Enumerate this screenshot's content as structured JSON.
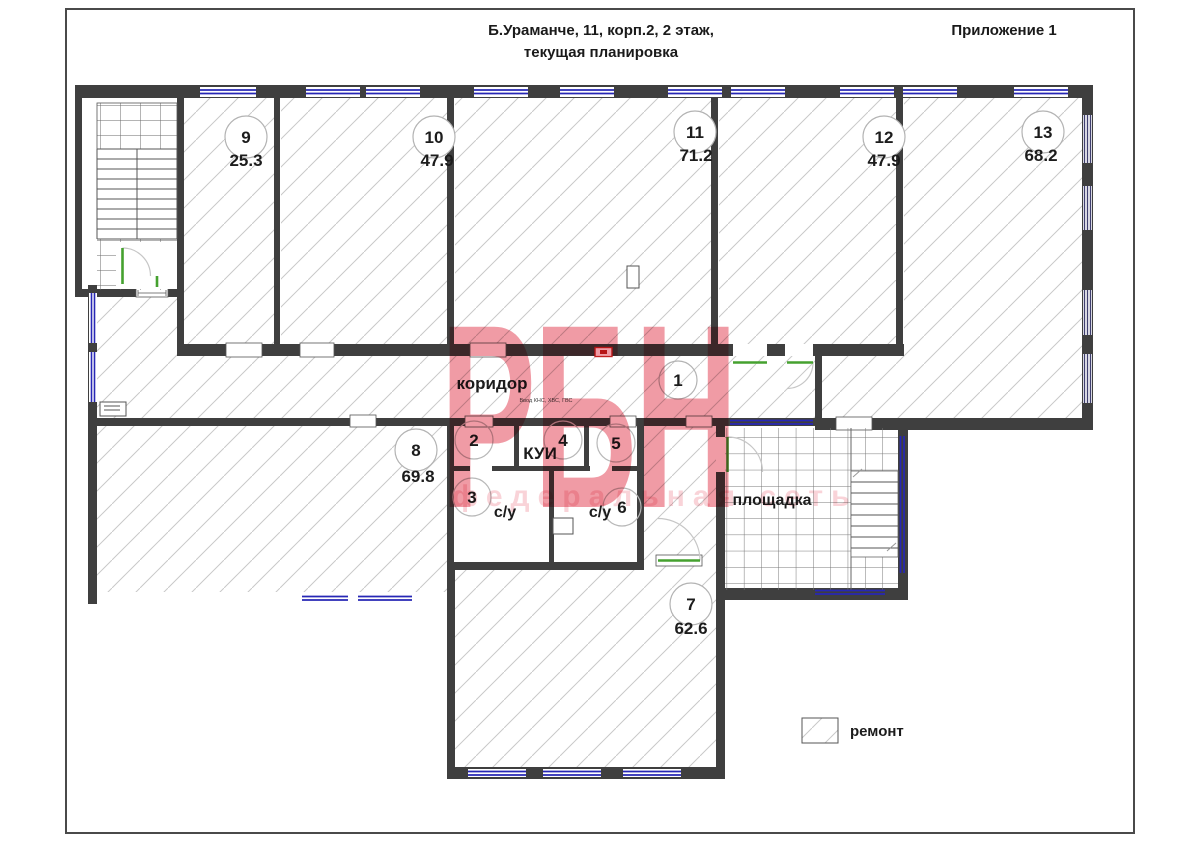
{
  "header": {
    "title_line1": "Б.Ураманче, 11, корп.2, 2 этаж,",
    "title_line2": "текущая планировка",
    "annex_label": "Приложение 1"
  },
  "plan": {
    "corridor_label": "коридор",
    "utility_note": "Ввод КНС, ХВС, ГВС",
    "kui_label": "КУИ",
    "bathroom_left_label": "с/у",
    "bathroom_right_label": "с/у",
    "landing_label": "площадка",
    "rooms": [
      {
        "number": "1"
      },
      {
        "number": "2"
      },
      {
        "number": "3"
      },
      {
        "number": "4"
      },
      {
        "number": "5"
      },
      {
        "number": "6"
      },
      {
        "number": "7",
        "area": "62.6"
      },
      {
        "number": "8",
        "area": "69.8"
      },
      {
        "number": "9",
        "area": "25.3"
      },
      {
        "number": "10",
        "area": "47.9"
      },
      {
        "number": "11",
        "area": "71.2"
      },
      {
        "number": "12",
        "area": "47.9"
      },
      {
        "number": "13",
        "area": "68.2"
      }
    ],
    "legend": {
      "repair_label": "ремонт"
    }
  },
  "watermark": {
    "logo_text": "РБН",
    "subtitle": "федеральная сеть"
  },
  "colors": {
    "wall": "#3f3f3f",
    "window_blue": "#2727b5",
    "door_green": "#45a12f",
    "hatch_gray": "#c9c9c9",
    "watermark_pink": "#e2384c",
    "marker_red": "#c22020"
  }
}
